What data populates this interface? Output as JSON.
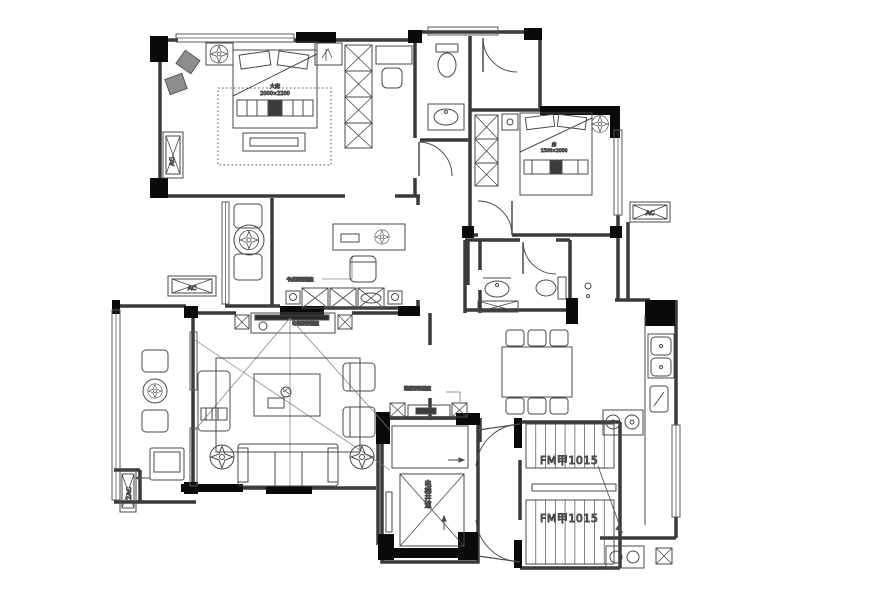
{
  "page": {
    "type": "architectural-floor-plan",
    "background": "#ffffff"
  },
  "labels": {
    "ac": "AC",
    "ac_double": "2AC",
    "fire_door_top": "FM甲1015",
    "fire_door_bottom": "FM甲1015",
    "master_bed_line1": "大床",
    "master_bed_line2": "2000×2200",
    "second_bed_line1": "床",
    "second_bed_line2": "1500×2000",
    "elevator_shaft": "电梯井道",
    "note_study": "书桌预留插座",
    "note_tv": "电视预留插座",
    "note_foyer": "鞋柜预留插座"
  },
  "colors": {
    "wall": "#1a1a1a",
    "line": "#3a3a3a",
    "furniture": "#4a4a4a",
    "label": "#555555"
  }
}
